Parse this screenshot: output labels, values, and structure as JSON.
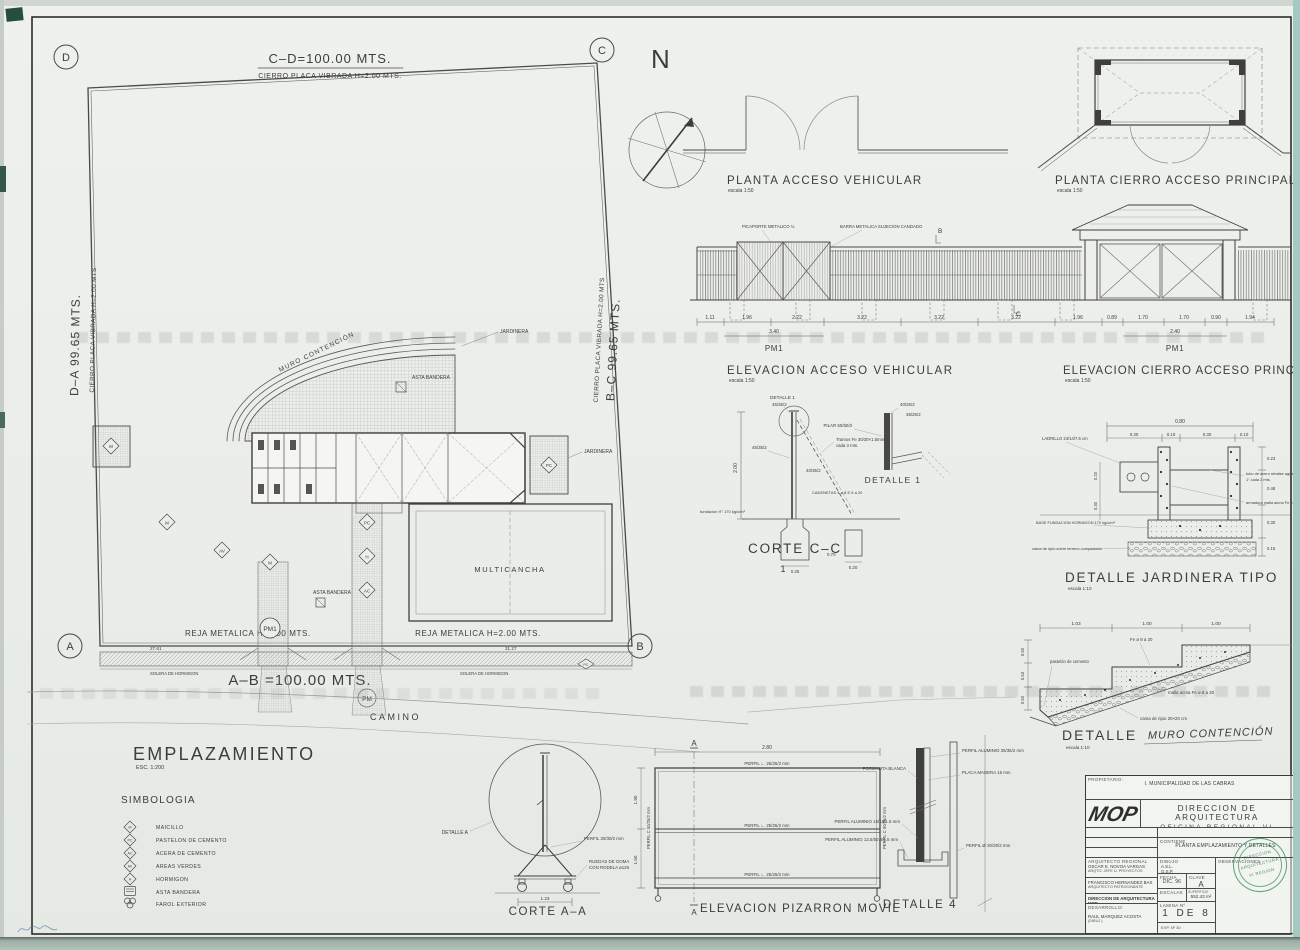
{
  "colors": {
    "paper": "#eceee9",
    "ink": "#3c3c3c",
    "stamp_green": "#388c64",
    "edge_teal": "#a3c9c1"
  },
  "north_label": "N",
  "site": {
    "corner_d": "D",
    "corner_c": "C",
    "corner_a": "A",
    "corner_b": "B",
    "dim_cd": "C–D=100.00 MTS.",
    "fence_cd": "CIERRO PLACA VIBRADA H=2.00 MTS.",
    "dim_da": "D–A 99.65 MTS.",
    "fence_da": "CIERRO PLACA VIBRADA H=2.00 MTS",
    "dim_bc": "B–C 99.65 MTS.",
    "fence_bc": "CIERRO PLACA VIBRADA H=2.00 MTS",
    "dim_ab": "A–B =100.00 MTS.",
    "reja_left": "REJA METALICA H=2.00 MTS.",
    "reja_right": "REJA METALICA H=2.00 MTS.",
    "camino": "CAMINO",
    "pm1": "PM1",
    "pm": "PM",
    "multicancha": "MULTICANCHA",
    "muro_contencion": "MURO CONTENCIÓN",
    "jardinera1": "JARDINERA",
    "jardinera2": "JARDINERA",
    "asta1": "ASTA BANDERA",
    "asta2": "ASTA BANDERA",
    "solera1": "SOLERA DE HORMIGON",
    "solera2": "SOLERA DE HORMIGON",
    "dim_sw_left": "27.61",
    "dim_sw_right": "31.27",
    "sym_m1": "M",
    "sym_av": "AV",
    "sym_pc1": "PC",
    "sym_h": "H",
    "sym_ac": "AC",
    "sym_m2": "M",
    "sym_pc2": "PC",
    "sym_pc3": "PC",
    "sym_m3": "M"
  },
  "planta_av": {
    "title": "PLANTA ACCESO VEHICULAR",
    "scale": "escala 1:50"
  },
  "planta_cap": {
    "title": "PLANTA CIERRO ACCESO PRINCIPAL",
    "scale": "escala 1:50"
  },
  "elev_av": {
    "title": "ELEVACION ACCESO VEHICULAR",
    "scale": "escala 1:50",
    "note1": "PICAPORTE METALICO ¾",
    "note2": "BARRA METALICA SUJECION CANDADO",
    "pm1": "PM1",
    "marker_b": "B",
    "marker_c": "C",
    "dims": [
      "1.11",
      "1.96",
      "2.22",
      "3.22",
      "3.22",
      "3.22",
      "1.96",
      "0.89",
      "1.70",
      "1.70",
      "0.90",
      "1.94"
    ],
    "sub_left": "3.40",
    "sub_right": "2.40"
  },
  "elev_cap": {
    "title": "ELEVACION CIERRO ACCESO PRINCIPAL",
    "scale": "escala 1:50",
    "pm1": "PM1"
  },
  "corte_cc": {
    "title": "CORTE C–C",
    "num": "1",
    "callout": "DETALLE 1",
    "callout2": "45/35/2",
    "a1": "45/35/2",
    "a2": "40/35/2",
    "brace1": "Tramos Fe 30/30×1.5mm",
    "brace2": "cada 3 mts.",
    "cadenetas": "CADENETAS 4 ø 8 E 6 a 20",
    "fund": "fundación H° 170 kg/c/m³",
    "dim_h": "2.00",
    "d1": "0.25",
    "d2": "0.70",
    "d3": "0.20"
  },
  "detalle_1": {
    "title": "DETALLE 1",
    "a1": "40/25/2",
    "a2": "35/25/2",
    "a3": "PILAR 50/50/3"
  },
  "jardinera": {
    "title": "DETALLE JARDINERA TIPO",
    "scale": "escala 1:10",
    "dim_total": "0.80",
    "dims_top": [
      "0.30",
      "0.10",
      "0.30",
      "0.10"
    ],
    "dims_right": [
      "0.23",
      "0.48",
      "0.30",
      "0.15"
    ],
    "dims_left": [
      "0.20",
      "0.30"
    ],
    "a_ladrillo": "LADRILLO 24/14/7.5 cm",
    "a_tubo1": "tubo de acero rebalse agua riego",
    "a_tubo2": "1\" cada 2 mts.",
    "a_malla": "armadura malla acma Fe 6 a 20",
    "a_base": "BASE FUNDACION HORMIGON 170 kg/c/m³",
    "a_ripio": "cama de ripio sobre terreno compactado"
  },
  "muro": {
    "title1": "DETALLE",
    "title2": "MURO CONTENCIÓN",
    "scale": "escala 1:10",
    "dims_top": [
      "1.03",
      "1.00",
      "1.00"
    ],
    "dims_left": [
      "0.50",
      "0.53",
      "0.50"
    ],
    "a1": "Fe ø 8 a 20",
    "a2": "pastelón de cemento",
    "a3": "malla acma Fe ø 8 a 20",
    "a4": "cama de ripio 20×20 cm"
  },
  "emplazamiento": {
    "title": "EMPLAZAMIENTO",
    "scale": "ESC. 1:200"
  },
  "simbologia": {
    "title": "SIMBOLOGIA",
    "items": [
      {
        "sym": "M",
        "label": "MAICILLO"
      },
      {
        "sym": "PC",
        "label": "PASTELON DE CEMENTO"
      },
      {
        "sym": "AC",
        "label": "ACERA DE CEMENTO"
      },
      {
        "sym": "AV",
        "label": "AREAS VERDES"
      },
      {
        "sym": "H",
        "label": "HORMIGON"
      },
      {
        "sym": "",
        "label": "ASTA BANDERA"
      },
      {
        "sym": "",
        "label": "FAROL EXTERIOR"
      }
    ]
  },
  "corte_aa": {
    "title": "CORTE A–A",
    "detalle_a": "DETALLE A",
    "perfil": "PERFIL 30/30/2 mm",
    "ruedas1": "RUEDAS DE GOMA",
    "ruedas2": "CON RODELA ø125",
    "dim": "1.23"
  },
  "pizarron": {
    "title": "ELEVACION PIZARRON MOVIL",
    "dim_w": "2.80",
    "dim_h1": "1.90",
    "dim_h2": "1.50",
    "perfil_top": "PERFIL ∟ 25/25/2 mm",
    "perfil_mid": "PERFIL ∟ 25/25/2 mm",
    "perfil_bot": "PERFIL ∟ 25/25/2 mm",
    "perfil_left": "PERFIL C 50/25/2 mm",
    "perfil_right": "PERFIL C 50/25/2 mm",
    "marker": "A"
  },
  "detalle_4": {
    "title": "DETALLE 4",
    "a1": "FORMALITA BLANCA",
    "a2": "PERFIL ALUMINIO 15/15/1.5 mm",
    "a3": "PERFIL ALUMINIO 13.5/50.8/1.5 mm",
    "a4": "PLACA MADERA 15 mm",
    "a5": "PERFIL Ø 30/30/2 mm",
    "a6": "PERFIL ALUMINIO 35/35/2 mm"
  },
  "title_block": {
    "propietario_label": "PROPIETARIO:",
    "propietario": "I. MUNICIPALIDAD DE LAS CABRAS",
    "logo": "MOP",
    "org1": "DIRECCION DE ARQUITECTURA",
    "org2": "OFICINA REGIONAL VI REGION",
    "region_label": "REGION",
    "region": "VI REGION",
    "obra_label": "OBRA",
    "obra": "REPOSICION ESCUELA G-496 VALDEBENITO",
    "provincia_label": "PROVINCIA",
    "provincia": "CACHAPOAL",
    "contiene_label": "CONTIENE",
    "contiene": "PLANTA EMPLAZAMIENTO Y DETALLES",
    "comuna_label": "COMUNA",
    "comuna": "LAS CABRAS",
    "arq_label": "ARQUITECTO REGIONAL",
    "arq_name": "OSCAR E. NOVOA VARGAS",
    "arq_title": "ARQTO. JEFE U. PROYECTOS",
    "patroc_name": "FRANCISCO HERNANDEZ BAS",
    "patroc_title": "ARQUITECTO PATROCINANTE",
    "firma": "DIRECCION DE ARQUITECTURA MOP",
    "desarrollo_label": "DESARROLLO:",
    "desarrollo_name": "RAUL MARQUEZ ACOSTA",
    "desarrollo_title": "(DIBUJ.)",
    "dibujo_label": "DIBUJO",
    "dibujo1": "A.S.L.",
    "dibujo2": "G.S.P.",
    "fecha_label": "FECHA",
    "fecha": "DIC. 96",
    "clave_label": "CLAVE",
    "clave": "A",
    "escalas_label": "ESCALAS",
    "superficie_label": "SUPERFICIE",
    "superficie": "552.43 m²",
    "lamina_label": "LAMINA Nº",
    "lamina": "1 DE 8",
    "exp": "EXP. Nº 30",
    "obs_label": "OBSERVACIONES",
    "stamp1": "DIRECCION",
    "stamp2": "ARQUITECTURA",
    "stamp3": "VI REGION"
  }
}
